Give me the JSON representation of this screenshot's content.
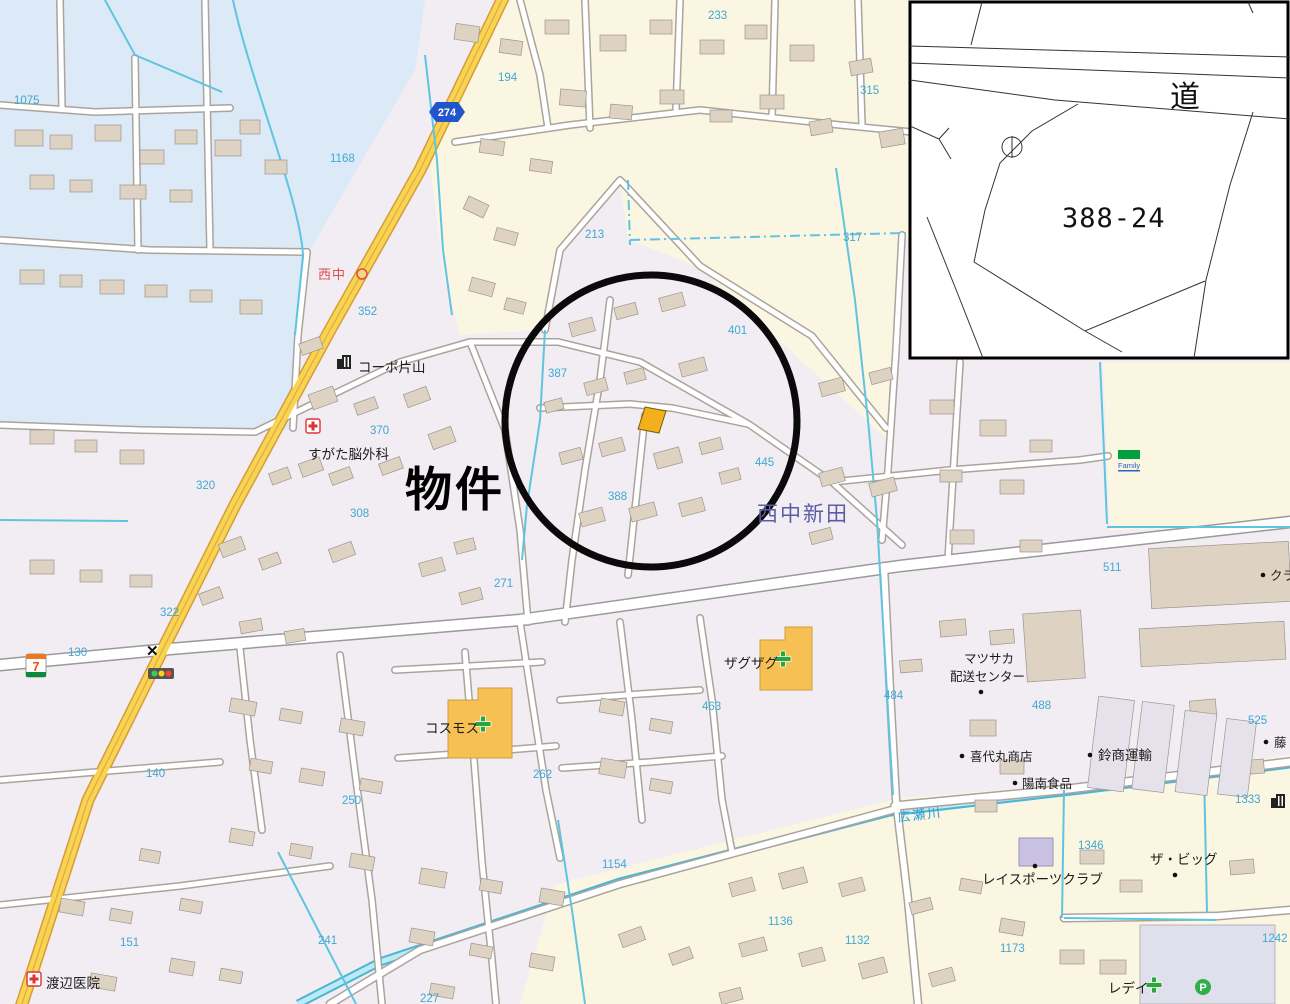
{
  "inset": {
    "road_label": "道",
    "parcel_number": "388-24"
  },
  "annotations": {
    "property_label": "物件"
  },
  "map": {
    "route_shield": "274",
    "bus_stop_label": "西中",
    "district_label": "西中新田",
    "river_label": "広瀬川",
    "x_mark": "✕",
    "pois": {
      "corpo_katayama": "コーポ片山",
      "sugata_neurosurgery": "すがた脳外科",
      "cosmos": "コスモス",
      "zagzag": "ザグザグ",
      "matsusaka_line1": "マツサカ",
      "matsusaka_line2": "配送センター",
      "kiyomaru_shoten": "喜代丸商店",
      "yonan_foods": "陽南食品",
      "suzusho_transport": "鈴商運輸",
      "rei_sports_club": "レイスポーツクラブ",
      "the_big": "ザ・ビッグ",
      "watanabe_clinic": "渡辺医院",
      "redei": "レデイ",
      "kura_partial": "クラ",
      "fuji_partial": "藤",
      "familymart": "Family",
      "parking": "P",
      "seven_eleven": "7"
    },
    "numbers": {
      "1075": "1075",
      "1168": "1168",
      "194": "194",
      "233": "233",
      "315": "315",
      "213": "213",
      "317": "317",
      "352": "352",
      "370": "370",
      "387": "387",
      "401": "401",
      "445": "445",
      "388": "388",
      "320": "320",
      "308": "308",
      "322": "322",
      "271": "271",
      "130": "130",
      "140": "140",
      "151": "151",
      "250": "250",
      "262": "262",
      "463": "463",
      "484": "484",
      "488": "488",
      "511": "511",
      "525": "525",
      "227": "227",
      "241": "241",
      "1154": "1154",
      "1136": "1136",
      "1132": "1132",
      "1173": "1173",
      "1242": "1242",
      "1333": "1333",
      "1346": "1346"
    }
  }
}
